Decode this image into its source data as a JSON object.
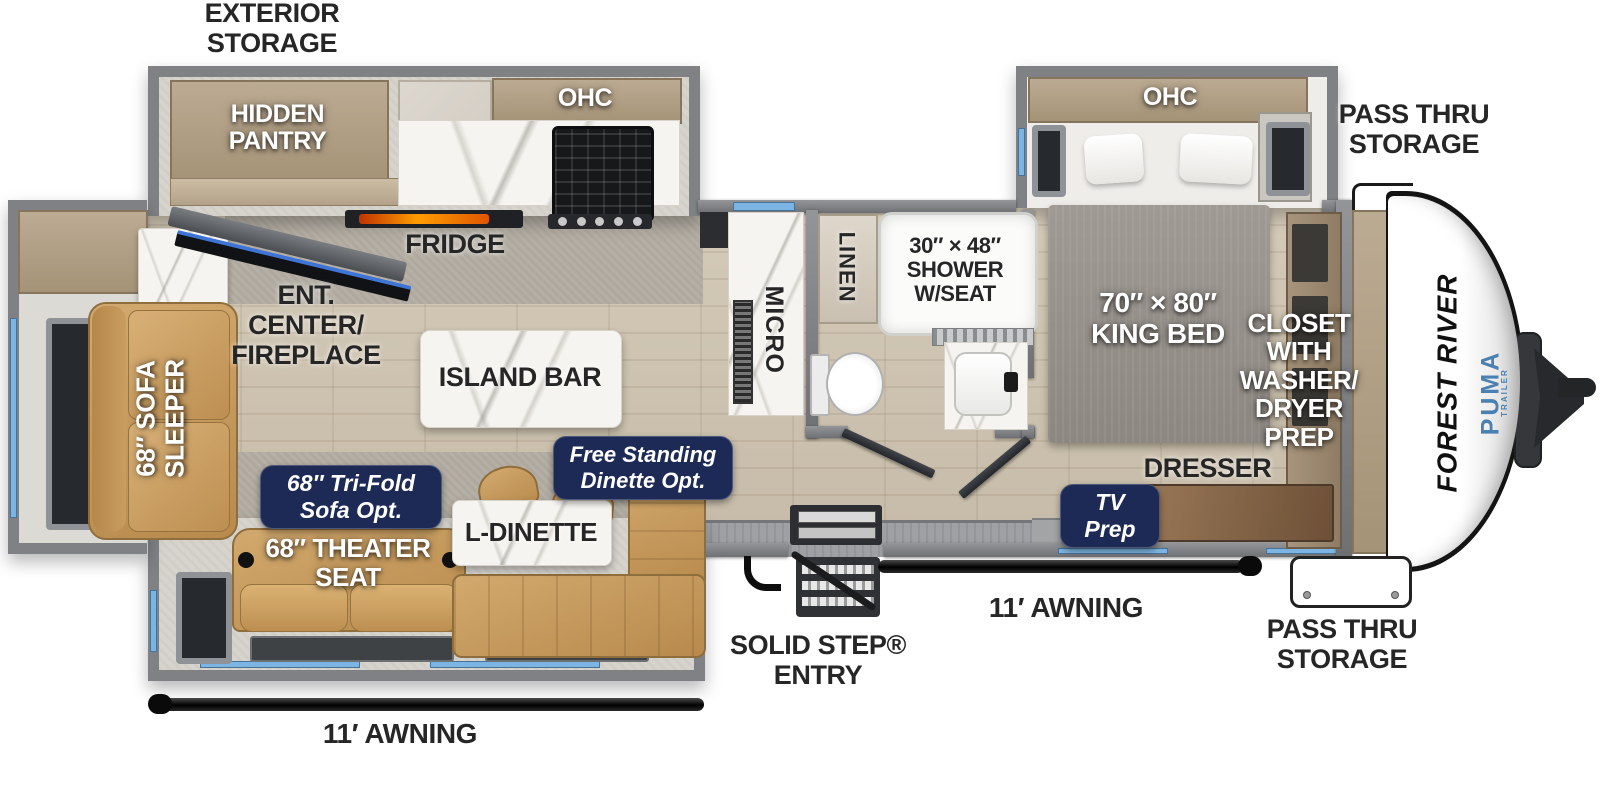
{
  "title": "Forest River Puma travel trailer floor plan",
  "colors": {
    "badge-navy": "#1d2a56",
    "accent-blue": "#7cb5e3",
    "brand-blue": "#4a80b2",
    "wall-gray": "#7f8184",
    "floor-wood": "#cdc3b2",
    "carpet-gray": "#b5afa5",
    "furniture-tan": "#c89b5e",
    "label-dark": "#262626",
    "marble-white": "#f6f4f0"
  },
  "labels": {
    "exterior_storage": "EXTERIOR\nSTORAGE",
    "hidden_pantry": "HIDDEN\nPANTRY",
    "ohc_kitchen": "OHC",
    "fridge": "FRIDGE",
    "ent_center": "ENT.\nCENTER/\nFIREPLACE",
    "island_bar": "ISLAND BAR",
    "sofa_sleeper": "68″ SOFA\nSLEEPER",
    "micro": "MICRO",
    "linen": "LINEN",
    "shower": "30″ × 48″\nSHOWER\nW/SEAT",
    "pass_thru_top": "PASS THRU\nSTORAGE",
    "ohc_bedroom": "OHC",
    "king_bed": "70″ × 80″\nKING BED",
    "closet": "CLOSET\nWITH\nWASHER/\nDRYER\nPREP",
    "dresser": "DRESSER",
    "tv_prep": "TV\nPrep",
    "tri_fold_opt": "68″ Tri-Fold\nSofa Opt.",
    "free_standing_opt": "Free Standing\nDinette Opt.",
    "l_dinette": "L-DINETTE",
    "theater_seat": "68″ THEATER\nSEAT",
    "solid_step_entry": "SOLID STEP®\nENTRY",
    "awning_left": "11′ AWNING",
    "awning_right": "11′ AWNING",
    "pass_thru_bottom": "PASS THRU\nSTORAGE",
    "brand_side": "FOREST RIVER",
    "brand_model": "PUMA",
    "brand_model_sub": "TRAILER"
  }
}
